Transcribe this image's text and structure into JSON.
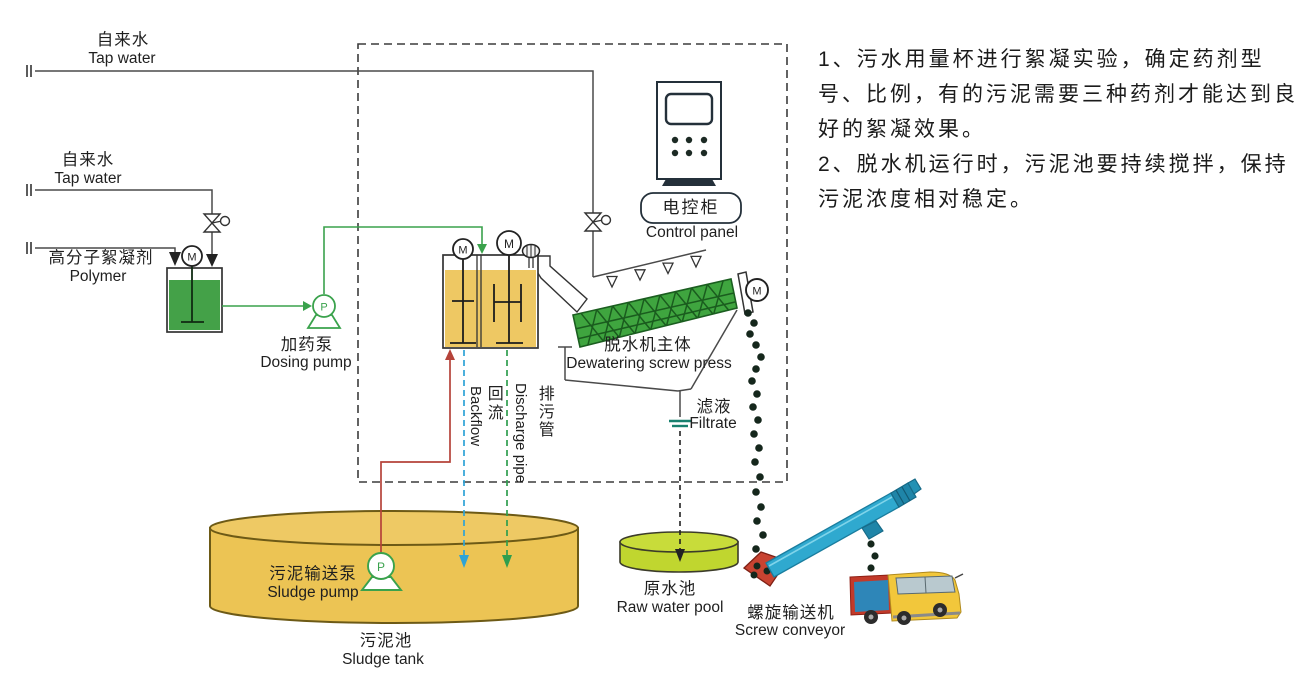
{
  "labels": {
    "tap_water_top": {
      "zh": "自来水",
      "en": "Tap water"
    },
    "tap_water_mid": {
      "zh": "自来水",
      "en": "Tap water"
    },
    "polymer": {
      "zh": "高分子絮凝剂",
      "en": "Polymer"
    },
    "dosing_pump": {
      "zh": "加药泵",
      "en": "Dosing pump"
    },
    "control_panel": {
      "zh": "电控柜",
      "en": "Control panel"
    },
    "dewatering_press": {
      "zh": "脱水机主体",
      "en": "Dewatering screw press"
    },
    "backflow": {
      "zh": "回流",
      "en": "Backflow"
    },
    "discharge_pipe": {
      "zh": "排污管",
      "en": "Discharge pipe"
    },
    "filtrate": {
      "zh": "滤液",
      "en": "Filtrate"
    },
    "raw_water_pool": {
      "zh": "原水池",
      "en": "Raw water pool"
    },
    "screw_conveyor": {
      "zh": "螺旋输送机",
      "en": "Screw conveyor"
    },
    "sludge_pump": {
      "zh": "污泥输送泵",
      "en": "Sludge pump"
    },
    "sludge_tank": {
      "zh": "污泥池",
      "en": "Sludge tank"
    }
  },
  "equipment_marks": {
    "motor": "M",
    "pump": "P"
  },
  "notes": {
    "lines": [
      "1、污水用量杯进行絮凝实验，确定药剂型",
      "号、比例，有的污泥需要三种药剂才能达到良",
      "好的絮凝效果。",
      "2、脱水机运行时，污泥池要持续搅拌，保持",
      "污泥浓度相对稳定。"
    ]
  },
  "colors": {
    "polymer_tank_green": "#44a148",
    "mixing_tank_yellow": "#eec863",
    "sludge_tank_yellow": "#ecc454",
    "raw_pool_green": "#c0d62f",
    "press_green": "#3fa53f",
    "conveyor_blue": "#2fa9cf",
    "hopper_red": "#c84331",
    "truck_cab_yellow": "#f2c73b",
    "cargo_blue": "#2e86b8",
    "dosing_line_green": "#3aa24c",
    "sludge_line_red": "#b5433a",
    "backflow_blue": "#2ea3d6",
    "discharge_green": "#2f9e4e"
  }
}
